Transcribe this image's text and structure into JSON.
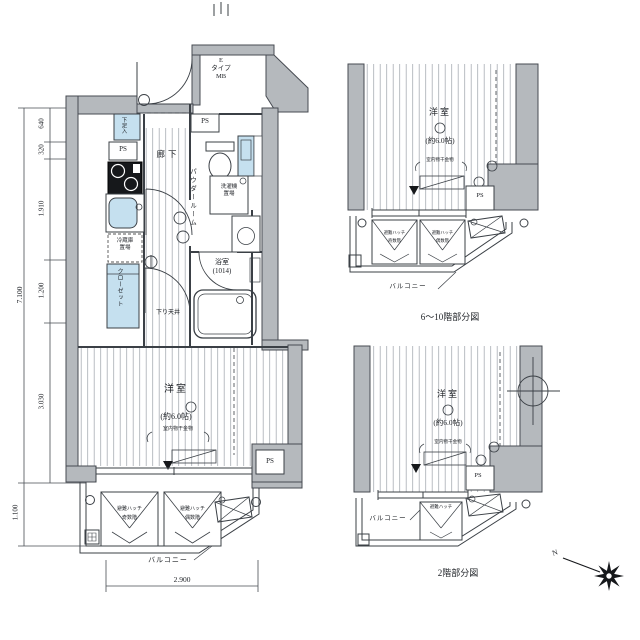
{
  "colors": {
    "wall_fill": "#b5b9bd",
    "wall_stroke": "#474b52",
    "line": "#3b4046",
    "fixture_blue": "#c5e0ef",
    "hatch_line": "#a9aeb4"
  },
  "main_plan": {
    "entrance_box": "E\nタイプ\nMB",
    "ps": "PS",
    "shoe_cabinet": "下足入",
    "hallway": "廊下",
    "powder_room": "パウダールーム",
    "washer_space": "洗濯機\n置場",
    "fridge_space": "冷蔵庫\n置場",
    "closet": "クローゼット",
    "bathroom": "浴室\n(1014)",
    "lowered_ceiling": "下り天井",
    "room": "洋室",
    "room_size": "(約6.0帖)",
    "laundry_hook": "室内物干金物",
    "balcony": "バルコニー",
    "hatch_odd": "避難ハッチ\n奇数階",
    "hatch_even": "避難ハッチ\n偶数階"
  },
  "dimensions": {
    "height_total": "7.100",
    "h1": "640",
    "h2": "320",
    "h3": "1.910",
    "h4": "1.200",
    "h5": "3.030",
    "balcony_depth": "1.100",
    "width": "2.900"
  },
  "upper_partial": {
    "caption": "6〜10階部分図",
    "room": "洋室",
    "room_size": "(約6.0帖)",
    "laundry_hook": "室内物干金物",
    "ps": "PS",
    "balcony": "バルコニー",
    "hatch_odd": "避難ハッチ\n奇数階",
    "hatch_even": "避難ハッチ\n偶数階"
  },
  "lower_partial": {
    "caption": "2階部分図",
    "room": "洋室",
    "room_size": "(約6.0帖)",
    "laundry_hook": "室内物干金物",
    "ps": "PS",
    "balcony": "バルコニー",
    "hatch": "避難ハッチ"
  },
  "compass": {
    "north": "N"
  }
}
